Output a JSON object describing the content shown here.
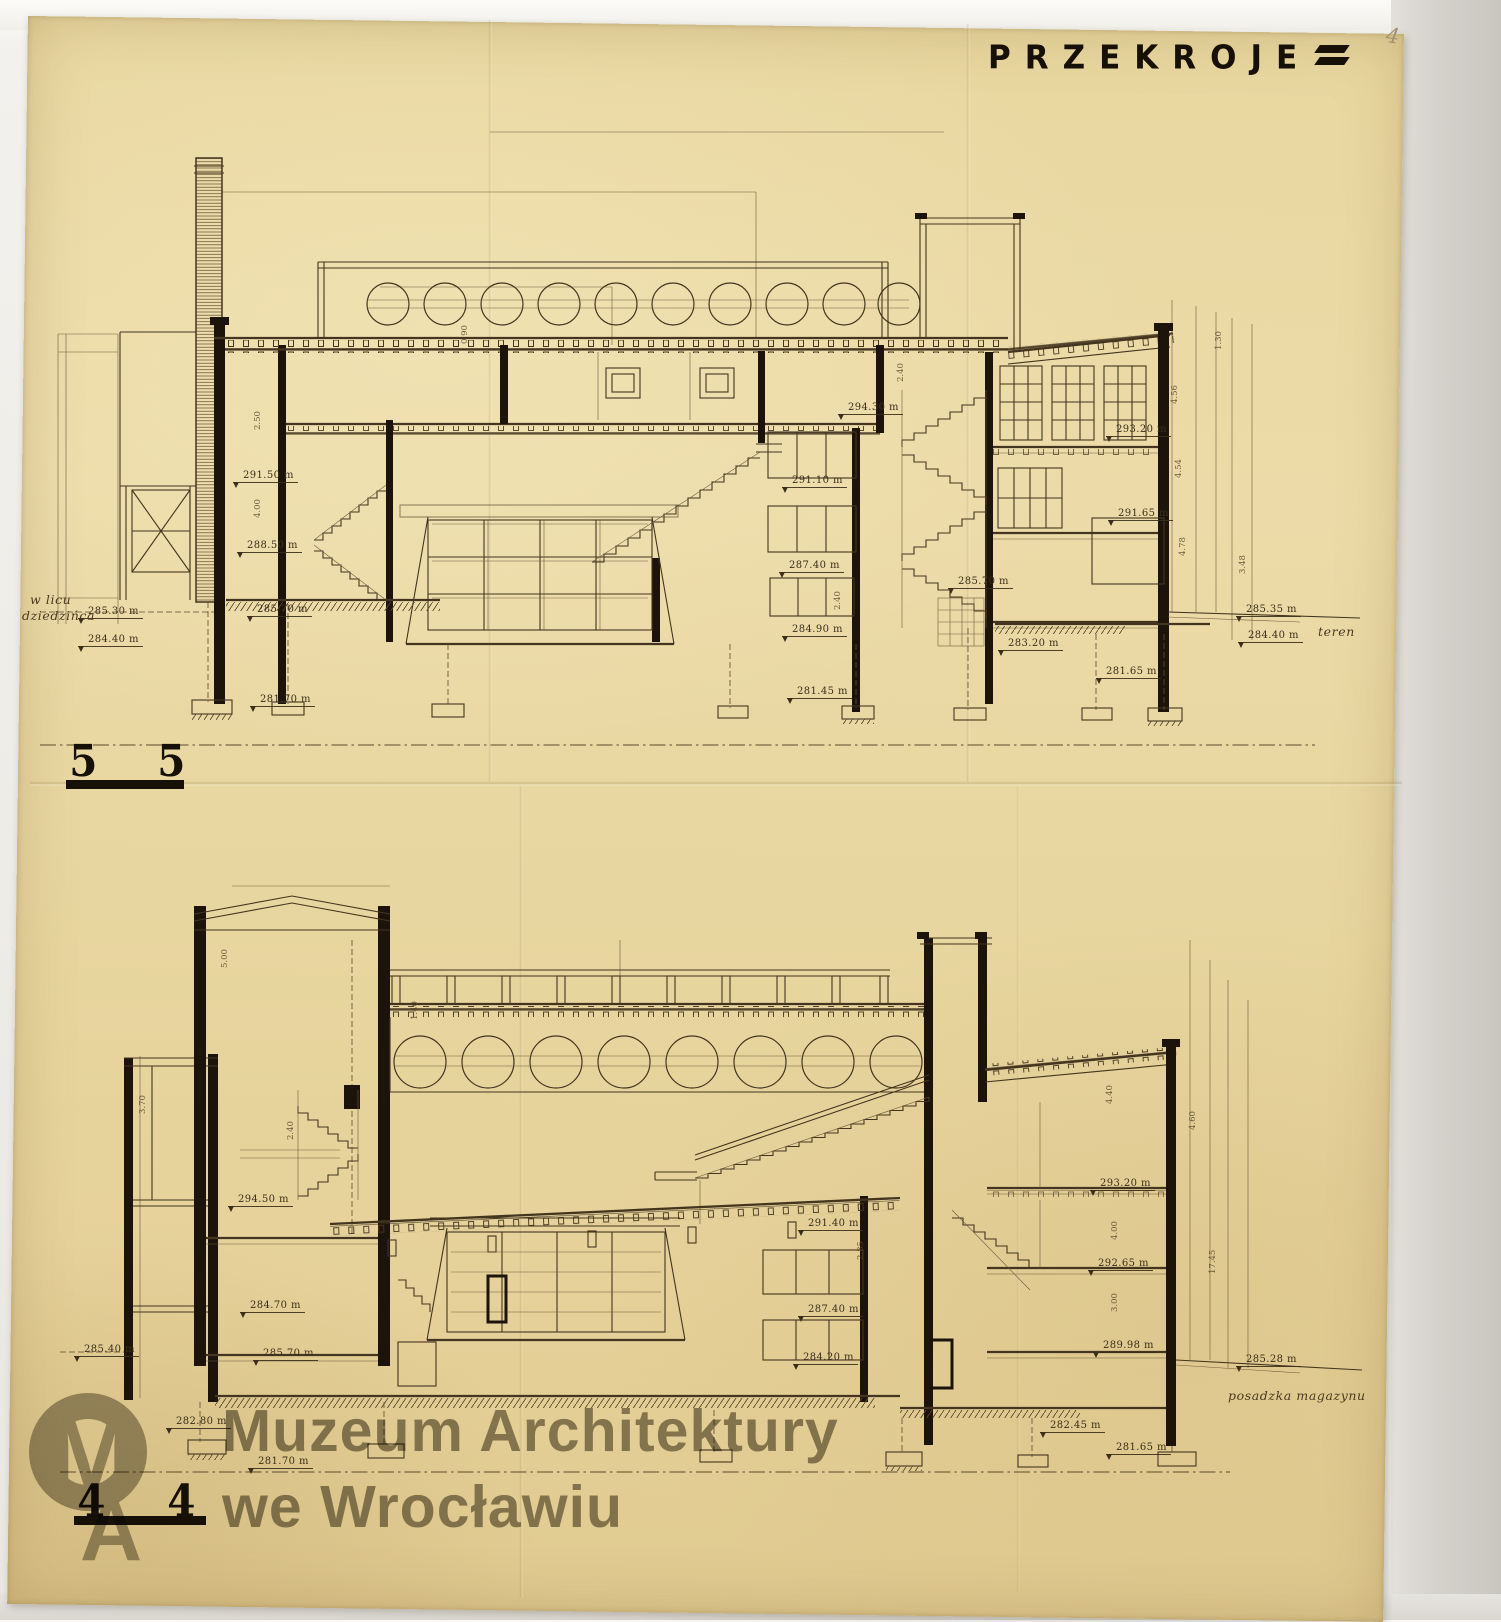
{
  "colors": {
    "paper": "#ead9a4",
    "ink": "#43351f",
    "wall_black": "#1c140a",
    "watermark_gray": "#6a6454",
    "backdrop_gray": "#d5d2cc"
  },
  "title": {
    "text": "PRZEKROJE"
  },
  "scan": {
    "page_number": "4"
  },
  "watermark": {
    "logo": "MA",
    "line1": "Muzeum Architektury",
    "line2": "we Wrocławiu"
  },
  "drawings": [
    {
      "name": "section-5-5",
      "marker_left": "5",
      "marker_right": "5",
      "annotations": [
        {
          "x": 78,
          "y": 606,
          "t": "285.30 m"
        },
        {
          "x": 78,
          "y": 634,
          "t": "284.40 m"
        },
        {
          "x": 233,
          "y": 470,
          "t": "291.50 m"
        },
        {
          "x": 237,
          "y": 540,
          "t": "288.50 m"
        },
        {
          "x": 247,
          "y": 604,
          "t": "285.70 m"
        },
        {
          "x": 250,
          "y": 694,
          "t": "281.70 m"
        },
        {
          "x": 838,
          "y": 402,
          "t": "294.30 m"
        },
        {
          "x": 782,
          "y": 475,
          "t": "291.10 m"
        },
        {
          "x": 779,
          "y": 560,
          "t": "287.40 m"
        },
        {
          "x": 782,
          "y": 624,
          "t": "284.90 m"
        },
        {
          "x": 787,
          "y": 686,
          "t": "281.45 m"
        },
        {
          "x": 948,
          "y": 576,
          "t": "285.70 m"
        },
        {
          "x": 998,
          "y": 638,
          "t": "283.20 m"
        },
        {
          "x": 1096,
          "y": 666,
          "t": "281.65 m"
        },
        {
          "x": 1106,
          "y": 424,
          "t": "293.20 m"
        },
        {
          "x": 1108,
          "y": 508,
          "t": "291.65 m"
        },
        {
          "x": 1236,
          "y": 604,
          "t": "285.35 m"
        },
        {
          "x": 1238,
          "y": 630,
          "t": "284.40 m"
        }
      ],
      "dim_labels": [
        {
          "x": 263,
          "y": 420,
          "t": "2.50"
        },
        {
          "x": 263,
          "y": 508,
          "t": "4.00"
        },
        {
          "x": 470,
          "y": 334,
          "t": "0.90"
        },
        {
          "x": 906,
          "y": 372,
          "t": "2.40"
        },
        {
          "x": 843,
          "y": 600,
          "t": "2.40"
        },
        {
          "x": 1180,
          "y": 394,
          "t": "4.56"
        },
        {
          "x": 1184,
          "y": 468,
          "t": "4.54"
        },
        {
          "x": 1188,
          "y": 546,
          "t": "4.78"
        },
        {
          "x": 1224,
          "y": 340,
          "t": "1.30"
        },
        {
          "x": 1248,
          "y": 564,
          "t": "3.48"
        }
      ],
      "notes": [
        {
          "x": 30,
          "y": 592,
          "t": "w licu"
        },
        {
          "x": 22,
          "y": 608,
          "t": "dziedzińca"
        },
        {
          "x": 1318,
          "y": 624,
          "t": "teren"
        }
      ]
    },
    {
      "name": "section-4-4",
      "marker_left": "4",
      "marker_right": "4",
      "annotations": [
        {
          "x": 228,
          "y": 1194,
          "t": "294.50 m"
        },
        {
          "x": 240,
          "y": 1300,
          "t": "284.70 m"
        },
        {
          "x": 74,
          "y": 1344,
          "t": "285.40 m"
        },
        {
          "x": 253,
          "y": 1348,
          "t": "285.70 m"
        },
        {
          "x": 166,
          "y": 1416,
          "t": "282.80 m"
        },
        {
          "x": 248,
          "y": 1456,
          "t": "281.70 m"
        },
        {
          "x": 798,
          "y": 1218,
          "t": "291.40 m"
        },
        {
          "x": 798,
          "y": 1304,
          "t": "287.40 m"
        },
        {
          "x": 793,
          "y": 1352,
          "t": "284.20 m"
        },
        {
          "x": 1090,
          "y": 1178,
          "t": "293.20 m"
        },
        {
          "x": 1088,
          "y": 1258,
          "t": "292.65 m"
        },
        {
          "x": 1093,
          "y": 1340,
          "t": "289.98 m"
        },
        {
          "x": 1040,
          "y": 1420,
          "t": "282.45 m"
        },
        {
          "x": 1106,
          "y": 1442,
          "t": "281.65 m"
        },
        {
          "x": 1236,
          "y": 1354,
          "t": "285.28 m"
        }
      ],
      "dim_labels": [
        {
          "x": 230,
          "y": 958,
          "t": "5.00"
        },
        {
          "x": 148,
          "y": 1104,
          "t": "3.70"
        },
        {
          "x": 420,
          "y": 1010,
          "t": "1.40"
        },
        {
          "x": 296,
          "y": 1130,
          "t": "2.40"
        },
        {
          "x": 866,
          "y": 1250,
          "t": "2.85"
        },
        {
          "x": 1115,
          "y": 1094,
          "t": "4.40"
        },
        {
          "x": 1198,
          "y": 1120,
          "t": "4.60"
        },
        {
          "x": 1120,
          "y": 1230,
          "t": "4.00"
        },
        {
          "x": 1120,
          "y": 1302,
          "t": "3.00"
        },
        {
          "x": 1218,
          "y": 1264,
          "t": "17.45"
        }
      ],
      "notes": [
        {
          "x": 1228,
          "y": 1388,
          "t": "posadzka magazynu"
        }
      ]
    }
  ]
}
